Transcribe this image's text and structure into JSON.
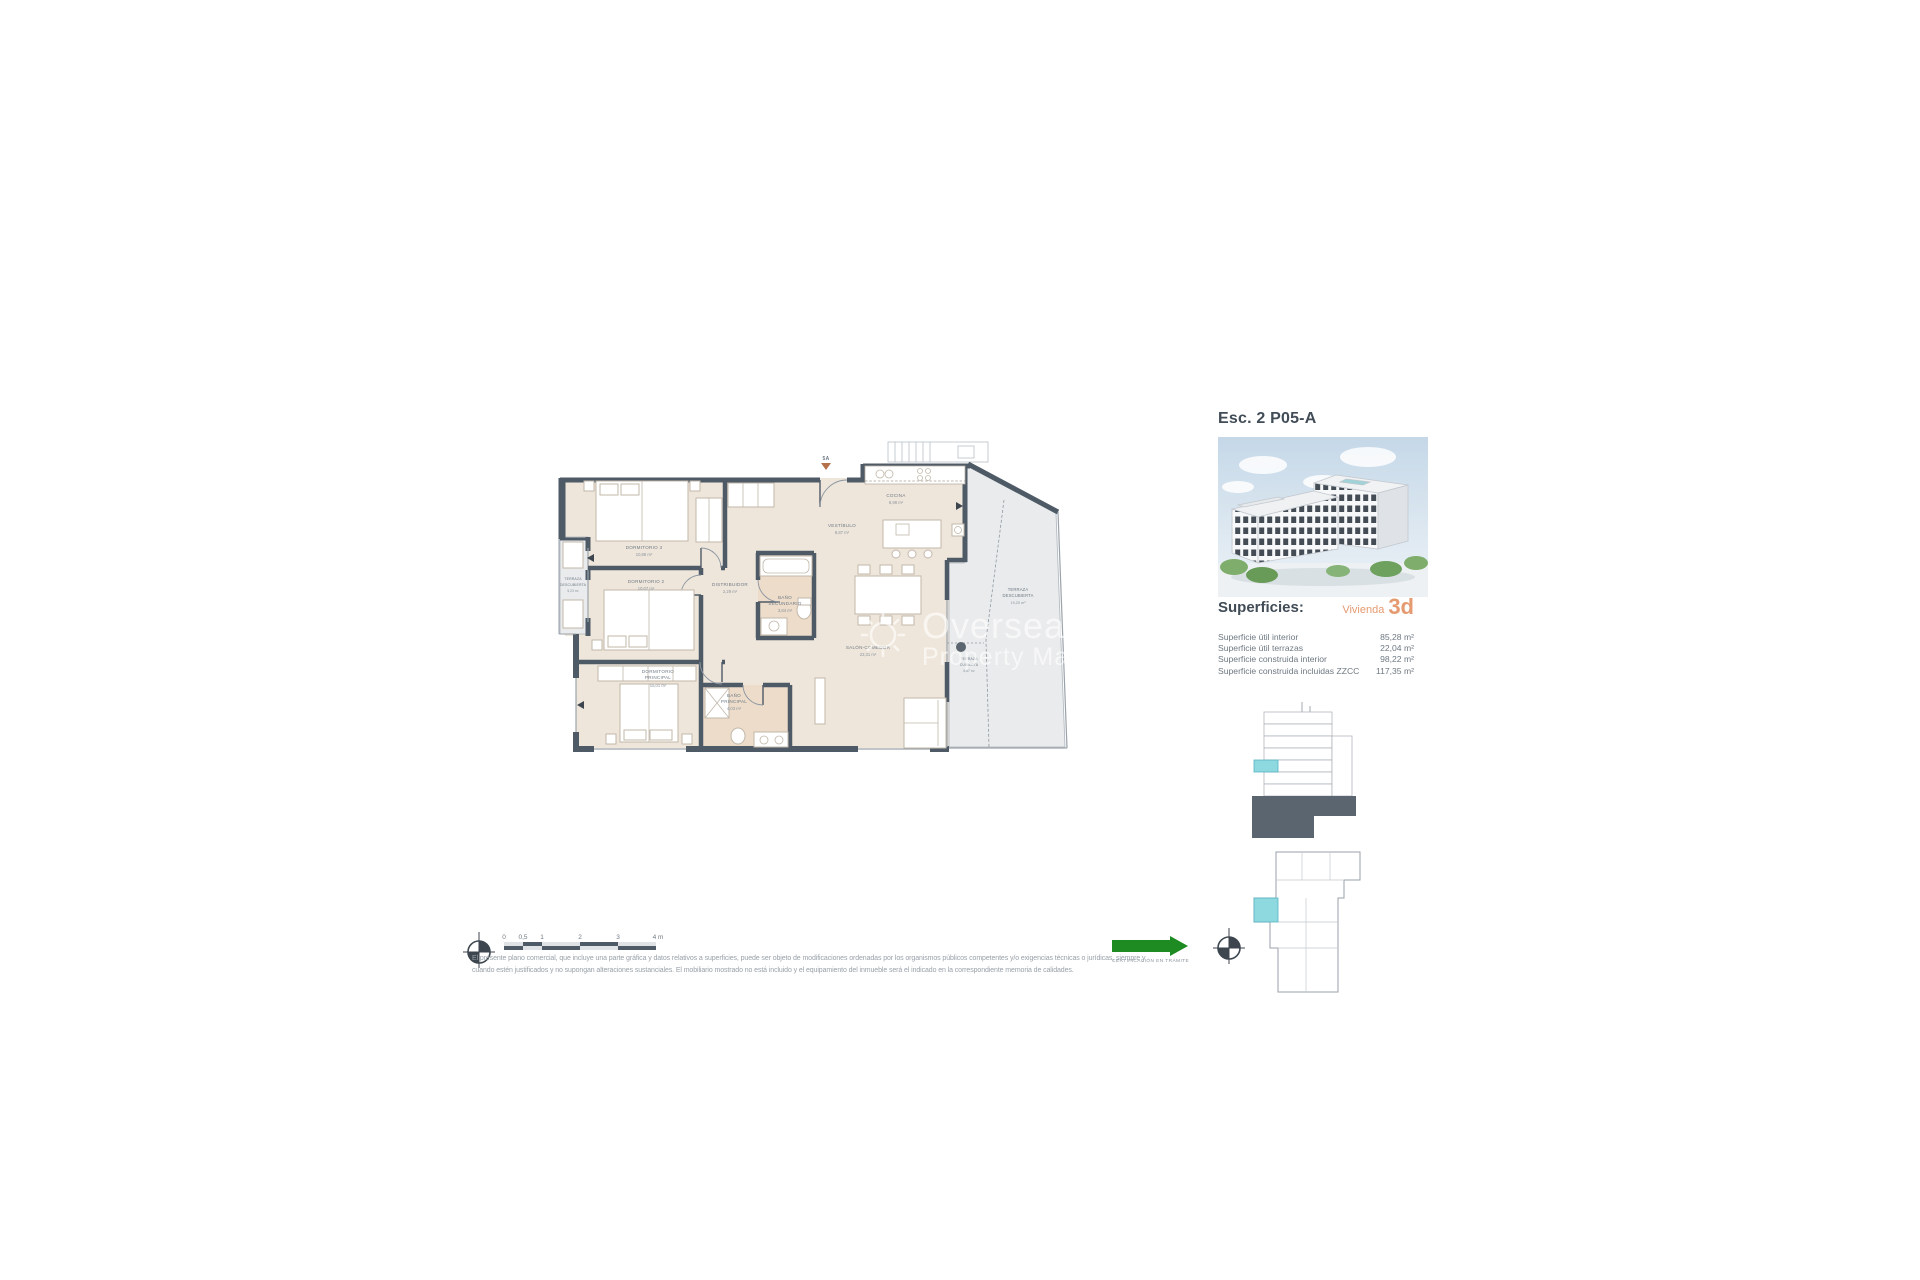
{
  "header": {
    "title": "Esc. 2 P05-A"
  },
  "watermark": {
    "line1": "Overseas",
    "line2": "Property Market"
  },
  "plan": {
    "entrance_label": "5A",
    "rooms": [
      {
        "l1": "DORMITORIO 3",
        "l2": "",
        "area": "10,88 m²"
      },
      {
        "l1": "DORMITORIO 2",
        "l2": "",
        "area": "10,07 m²"
      },
      {
        "l1": "DORMITORIO",
        "l2": "PRINCIPAL",
        "area": "15,01 m²"
      },
      {
        "l1": "BAÑO",
        "l2": "PRINCIPAL",
        "area": "4,03 m²"
      },
      {
        "l1": "BAÑO",
        "l2": "SECUNDARIO",
        "area": "3,84 m²"
      },
      {
        "l1": "DISTRIBUIDOR",
        "l2": "",
        "area": "2,29 m²"
      },
      {
        "l1": "VESTÍBULO",
        "l2": "",
        "area": "8,87 m²"
      },
      {
        "l1": "COCINA",
        "l2": "",
        "area": "6,98 m²"
      },
      {
        "l1": "SALÓN-COMEDOR",
        "l2": "",
        "area": "23,31 m²"
      },
      {
        "l1": "TERRAZA",
        "l2": "DESCUBIERTA",
        "area": "5,23 m²"
      },
      {
        "l1": "TERRAZA",
        "l2": "DESCUBIERTA",
        "area": "19,20 m²"
      },
      {
        "l1": "TERRAZA",
        "l2": "CUBIERTA",
        "area": "6,87 m²"
      }
    ]
  },
  "info": {
    "heading": "Superficies:",
    "vivienda_label": "Vivienda",
    "vivienda_number": "3d",
    "rows": [
      {
        "label": "Superficie útil interior",
        "value": "85,28 m²"
      },
      {
        "label": "Superficie útil terrazas",
        "value": "22,04 m²"
      },
      {
        "label": "Superficie construida interior",
        "value": "98,22 m²"
      },
      {
        "label": "Superficie construida incluidas ZZCC",
        "value": "117,35 m²"
      }
    ]
  },
  "scalebar": {
    "ticks": [
      "0",
      "0,5",
      "1",
      "2",
      "3",
      "4 m"
    ]
  },
  "cert": {
    "label": "CERTIFICACIÓN EN TRÁMITE"
  },
  "footer": {
    "lines": [
      "El presente plano comercial, que incluye una parte gráfica y datos relativos a superficies, puede ser objeto de modificaciones ordenadas por los organismos públicos competentes y/o exigencias técnicas o jurídicas, siempre y",
      "cuando estén justificados y no supongan alteraciones sustanciales. El mobiliario mostrado no está incluido y el equipamiento del inmueble será el indicado en la correspondiente memoria de calidades."
    ]
  },
  "colors": {
    "accent_orange": "#E59A70",
    "highlight_cyan": "#8ED8E0",
    "cert_green": "#1E8A22",
    "wall": "#4E5A66"
  }
}
